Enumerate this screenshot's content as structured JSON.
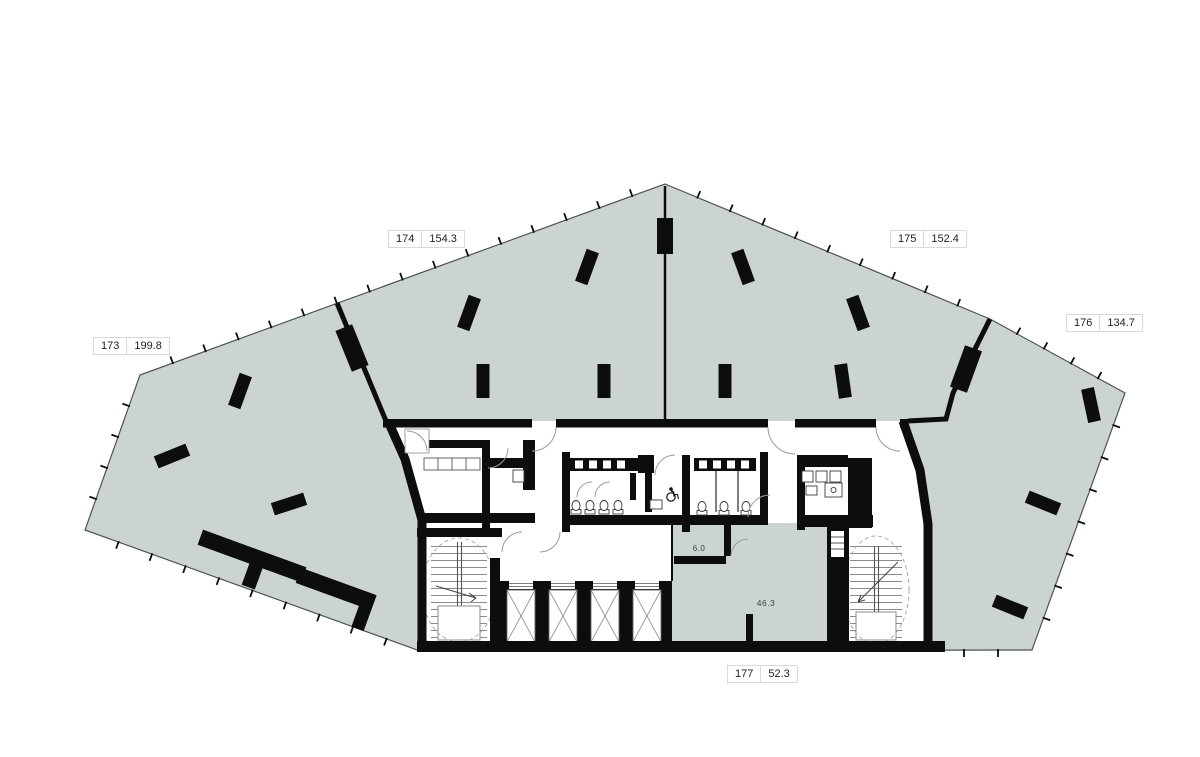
{
  "page": {
    "title": "Floor plan"
  },
  "units": [
    {
      "id": "173",
      "area": "199.8"
    },
    {
      "id": "174",
      "area": "154.3"
    },
    {
      "id": "175",
      "area": "152.4"
    },
    {
      "id": "176",
      "area": "134.7"
    },
    {
      "id": "177",
      "area": "52.3"
    }
  ],
  "interior_labels": {
    "small_room": "6.0",
    "open_area": "46.3"
  },
  "colors": {
    "floor": "#ccd4d0",
    "wall": "#0d0d0d",
    "line": "#4e534f",
    "door": "#9b9b9b",
    "dash": "#a7aba9",
    "label-border": "#d9d9d9",
    "label-text": "#1f1f1f"
  }
}
